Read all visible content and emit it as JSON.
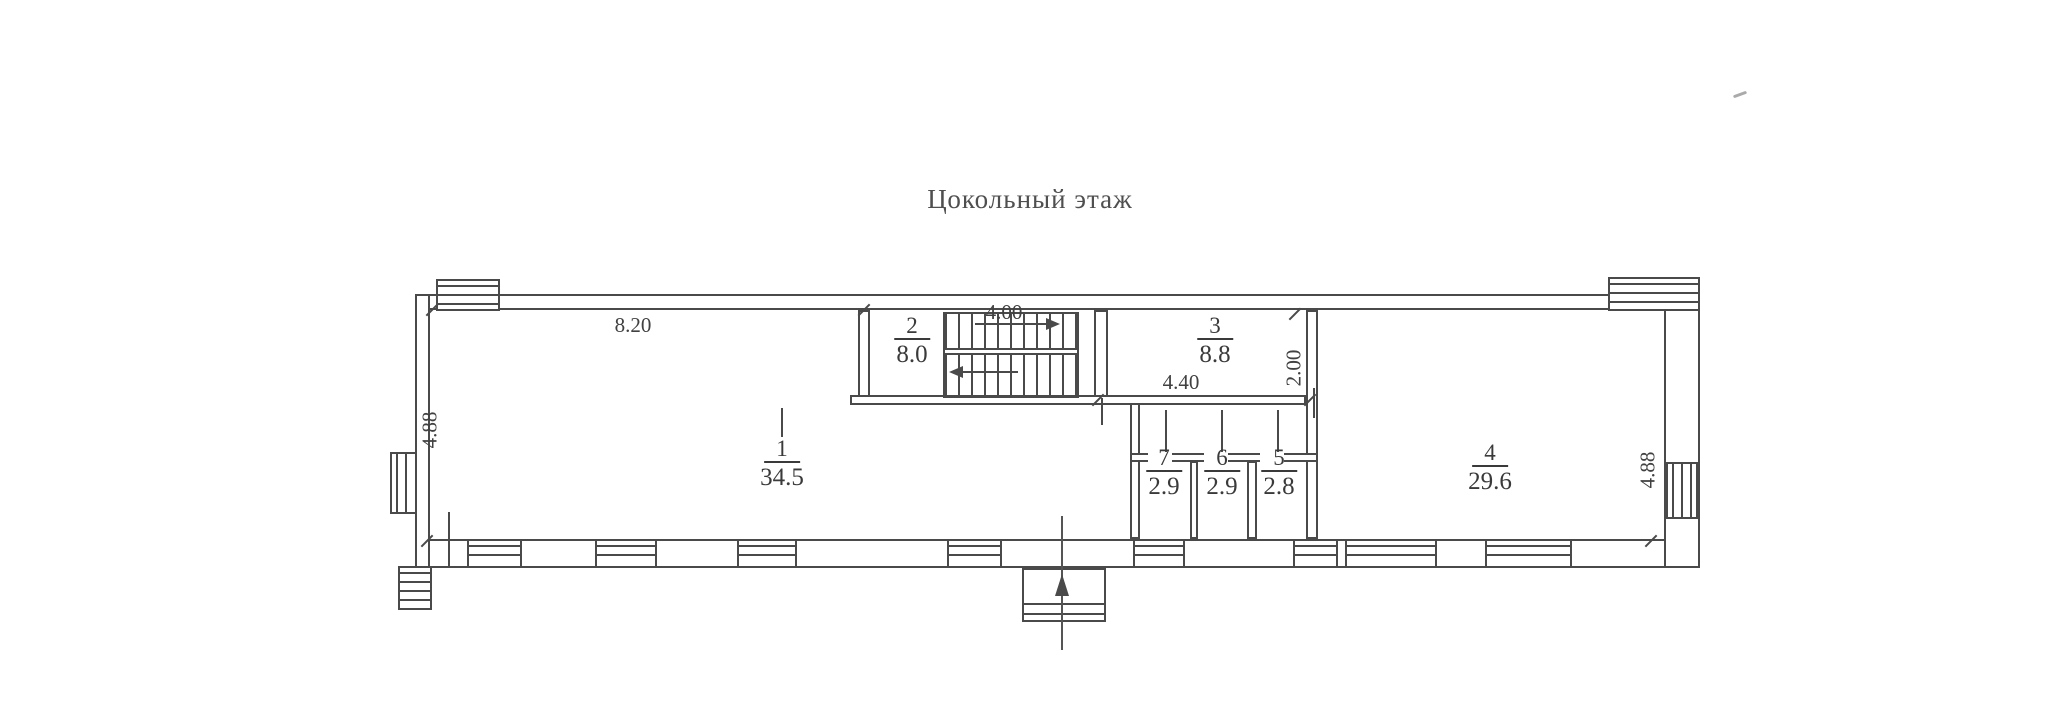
{
  "title": "Цокольный этаж",
  "plan": {
    "rooms": [
      {
        "number": "1",
        "area": "34.5"
      },
      {
        "number": "2",
        "area": "8.0"
      },
      {
        "number": "3",
        "area": "8.8"
      },
      {
        "number": "4",
        "area": "29.6"
      },
      {
        "number": "5",
        "area": "2.8"
      },
      {
        "number": "6",
        "area": "2.9"
      },
      {
        "number": "7",
        "area": "2.9"
      }
    ],
    "dimensions": {
      "top_left": "8.20",
      "stairs": "4.00",
      "corridor": "4.40",
      "vestibule_depth": "2.00",
      "left_height": "4.88",
      "right_height": "4.88"
    },
    "colors": {
      "line": "#4a4a4a",
      "paper": "#ffffff",
      "text": "#3a3a3a"
    }
  }
}
